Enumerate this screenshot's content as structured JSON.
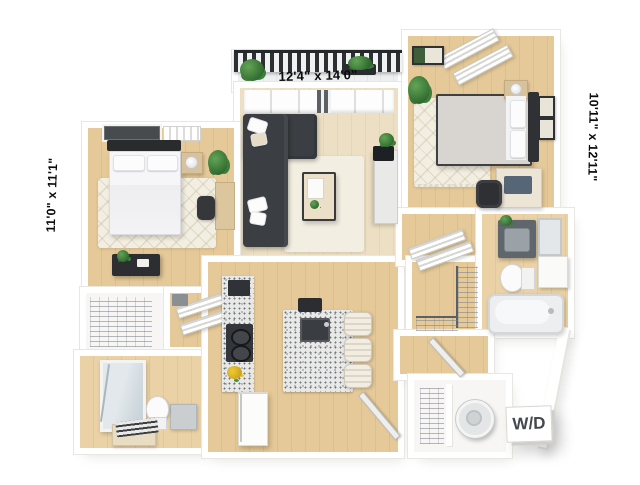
{
  "floorplan": {
    "labels": {
      "living_dims": "12'4\" x 14'0\"",
      "bedroom_left_dims": "11'0\" x 11'1\"",
      "bedroom_right_dims": "10'11\" x 12'11\"",
      "washer_dryer": "W/D"
    },
    "colors": {
      "background": "#ffffff",
      "wall": "#ffffff",
      "wall_edge": "#e9e7e1",
      "floor_wood": "#e5c998",
      "floor_living": "#ecdfc4",
      "rug": "#f2eee1",
      "sofa": "#3b3e42",
      "railing": "#2c3033",
      "plant_green": "#3e7c3a",
      "granite": "#e8e8e6",
      "appliance_dark": "#2f3236",
      "fixture_white": "#f6f7f8",
      "label_text": "#0b0b0b",
      "wd_text": "#43484d"
    }
  }
}
